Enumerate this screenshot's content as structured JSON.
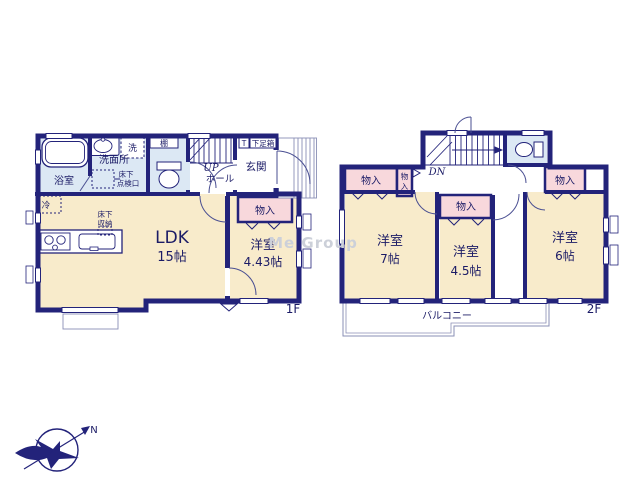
{
  "watermark": "Me Group",
  "compass": {
    "north_label": "N"
  },
  "colors": {
    "wall": "#23237a",
    "room": "#f8ebcb",
    "wet_area": "#dce8f4",
    "closet": "#f8d8dc",
    "text": "#1b1b66"
  },
  "f1": {
    "floor_label": "1F",
    "bath_label": "浴室",
    "washroom_label": "洗面所",
    "washer_label": "洗",
    "inspection_hatch_line1": "床下",
    "inspection_hatch_line2": "点検口",
    "shelf_label": "棚",
    "stairs_up_label": "UP",
    "hall_label": "ホール",
    "shoe_t_label": "T",
    "shoebox_label": "下足箱",
    "entrance_label": "玄関",
    "closet_label": "物入",
    "fridge_label": "冷",
    "floor_storage_line1": "床下",
    "floor_storage_line2": "収納",
    "ldk_label": "LDK",
    "ldk_size": "15帖",
    "bedroom_label": "洋室",
    "bedroom_size": "4.43帖"
  },
  "f2": {
    "floor_label": "2F",
    "stairs_down_label": "DN",
    "closet_left_label": "物入",
    "closet_small_char1": "物",
    "closet_small_char2": "入",
    "closet_mid_label": "物入",
    "closet_right_label": "物入",
    "room7_label": "洋室",
    "room7_size": "7帖",
    "room45_label": "洋室",
    "room45_size": "4.5帖",
    "room6_label": "洋室",
    "room6_size": "6帖",
    "balcony_label": "バルコニー"
  }
}
